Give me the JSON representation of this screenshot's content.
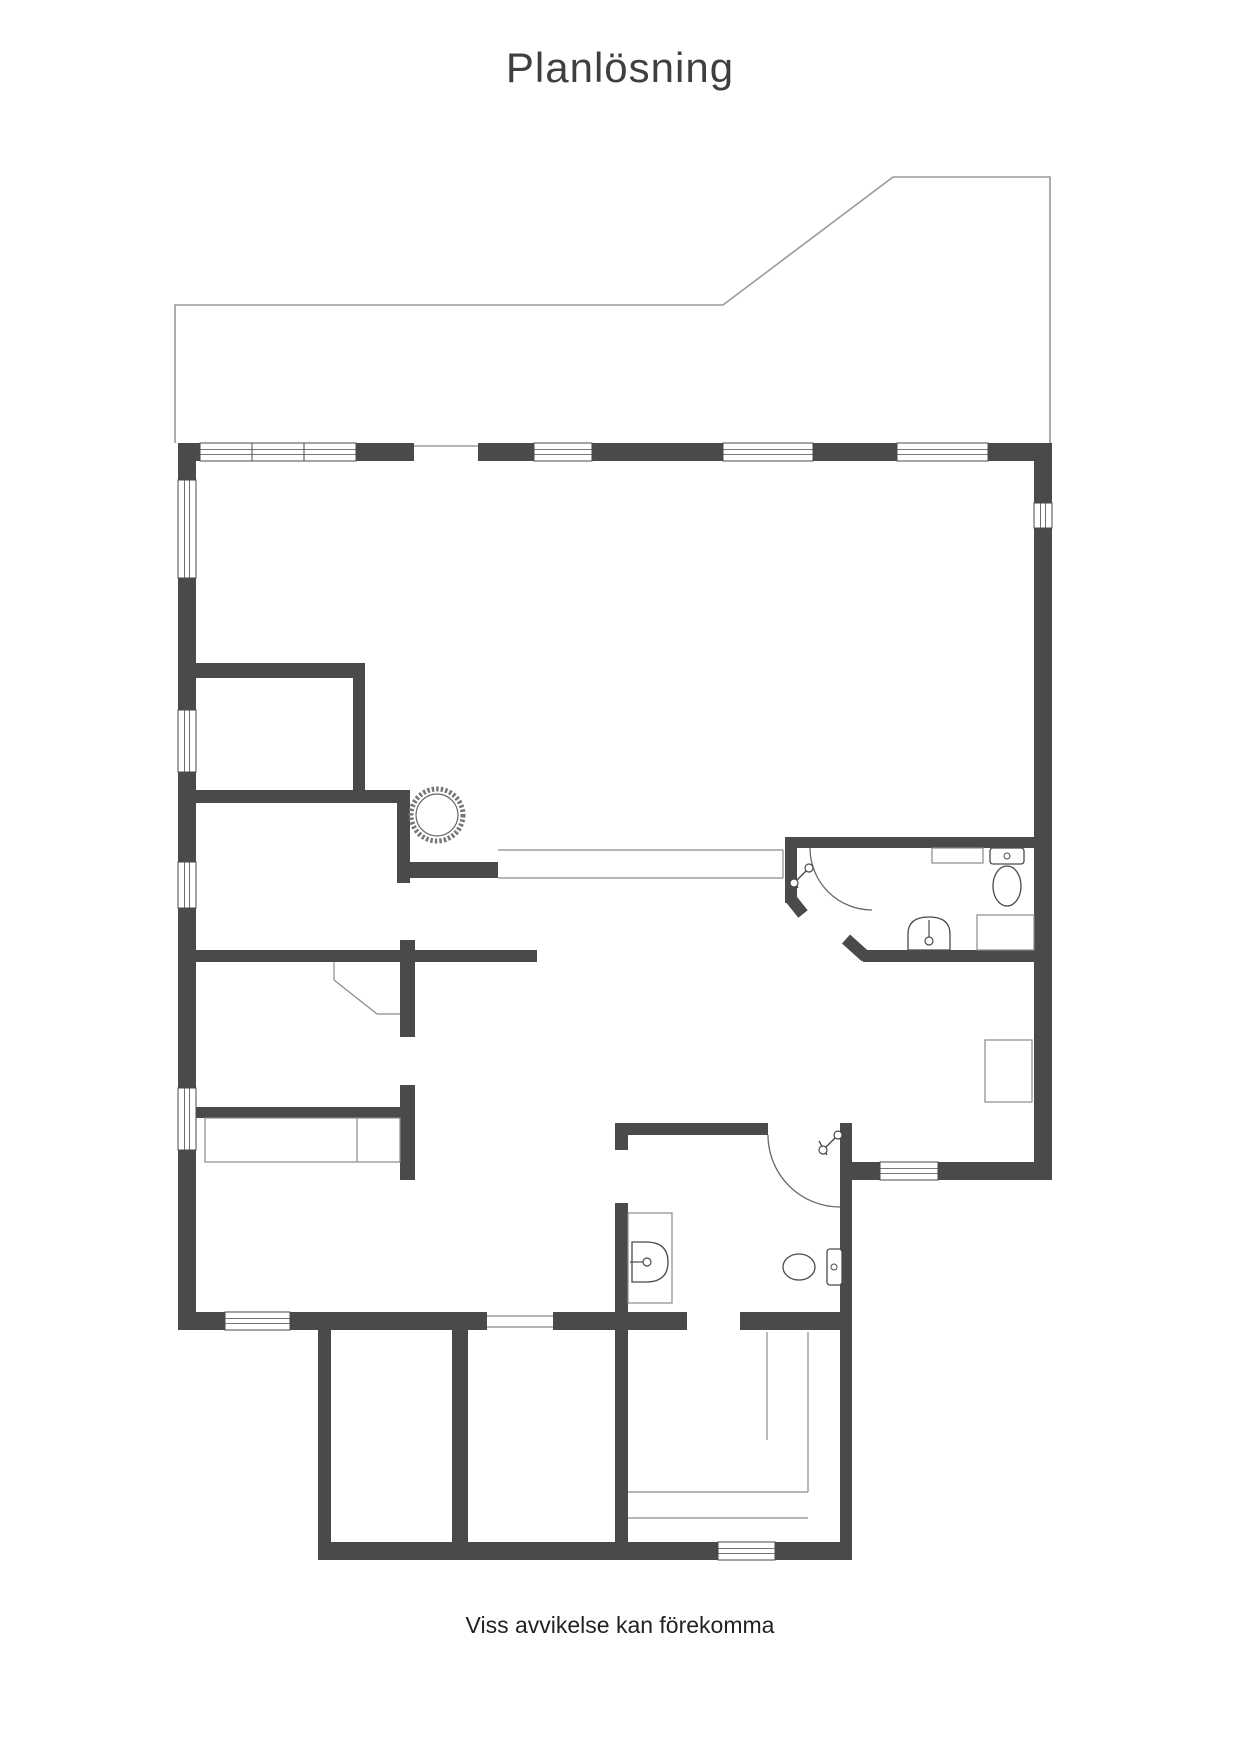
{
  "page": {
    "title": "Planlösning",
    "footer": "Viss avvikelse kan förekomma"
  },
  "colors": {
    "wall": "#4a4a4a",
    "thin": "#8a8a8a",
    "deck": "#999999",
    "fixture": "#4a4a4a",
    "background": "#ffffff"
  },
  "floorplan": {
    "canvas": {
      "width": 1240,
      "height": 1754
    },
    "deck_outline": "M175,443 L175,305 L723,305 L893,177 L1050,177 L1050,443",
    "walls": [
      [
        178,
        443,
        22,
        18
      ],
      [
        356,
        443,
        58,
        18
      ],
      [
        478,
        443,
        56,
        18
      ],
      [
        592,
        443,
        131,
        18
      ],
      [
        813,
        443,
        84,
        18
      ],
      [
        988,
        443,
        64,
        18
      ],
      [
        178,
        461,
        18,
        19
      ],
      [
        178,
        578,
        18,
        132
      ],
      [
        178,
        772,
        18,
        90
      ],
      [
        178,
        908,
        18,
        180
      ],
      [
        178,
        1150,
        18,
        162
      ],
      [
        1034,
        461,
        18,
        42
      ],
      [
        1034,
        528,
        18,
        634
      ],
      [
        852,
        1162,
        200,
        18
      ],
      [
        178,
        1312,
        309,
        18
      ],
      [
        553,
        1312,
        134,
        18
      ],
      [
        740,
        1312,
        112,
        18
      ],
      [
        318,
        1330,
        13,
        212
      ],
      [
        318,
        1542,
        534,
        18
      ],
      [
        452,
        1330,
        16,
        212
      ],
      [
        615,
        1123,
        13,
        27
      ],
      [
        615,
        1203,
        13,
        339
      ],
      [
        617,
        1123,
        151,
        12
      ],
      [
        840,
        1123,
        12,
        419
      ],
      [
        196,
        663,
        169,
        15
      ],
      [
        353,
        678,
        12,
        112
      ],
      [
        196,
        790,
        214,
        13
      ],
      [
        397,
        803,
        13,
        80
      ],
      [
        410,
        862,
        88,
        16
      ],
      [
        196,
        950,
        341,
        12
      ],
      [
        400,
        940,
        15,
        97
      ],
      [
        196,
        1107,
        204,
        11
      ],
      [
        400,
        1085,
        15,
        95
      ],
      [
        785,
        837,
        249,
        11
      ],
      [
        785,
        837,
        12,
        66
      ],
      [
        863,
        950,
        171,
        12
      ]
    ],
    "diag_walls": [
      [
        791,
        899,
        803,
        914,
        12
      ],
      [
        846,
        939,
        866,
        957,
        12
      ]
    ],
    "windows": [
      [
        200,
        443,
        52,
        18,
        "h"
      ],
      [
        252,
        443,
        52,
        18,
        "h"
      ],
      [
        304,
        443,
        52,
        18,
        "h"
      ],
      [
        534,
        443,
        58,
        18,
        "h"
      ],
      [
        723,
        443,
        90,
        18,
        "h"
      ],
      [
        897,
        443,
        91,
        18,
        "h"
      ],
      [
        178,
        480,
        18,
        98,
        "v"
      ],
      [
        178,
        710,
        18,
        62,
        "v"
      ],
      [
        178,
        862,
        18,
        46,
        "v"
      ],
      [
        178,
        1088,
        18,
        62,
        "v"
      ],
      [
        1034,
        503,
        18,
        25,
        "v"
      ],
      [
        880,
        1162,
        58,
        18,
        "h"
      ],
      [
        718,
        1542,
        57,
        18,
        "h"
      ],
      [
        225,
        1312,
        65,
        18,
        "h"
      ]
    ],
    "thin_lines": [
      [
        414,
        446,
        478,
        446
      ],
      [
        487,
        1316,
        553,
        1316
      ],
      [
        487,
        1327,
        553,
        1327
      ],
      [
        498,
        850,
        783,
        850
      ],
      [
        498,
        878,
        783,
        878
      ],
      [
        783,
        850,
        783,
        878
      ],
      [
        334,
        962,
        334,
        980
      ],
      [
        334,
        980,
        377,
        1014
      ],
      [
        377,
        1014,
        400,
        1014
      ],
      [
        357,
        1118,
        357,
        1162
      ],
      [
        767,
        1332,
        767,
        1440
      ],
      [
        808,
        1332,
        808,
        1440
      ],
      [
        808,
        1440,
        808,
        1492
      ],
      [
        628,
        1492,
        808,
        1492
      ],
      [
        628,
        1518,
        808,
        1518
      ]
    ],
    "thin_rects": [
      [
        205,
        1118,
        195,
        44
      ],
      [
        628,
        1213,
        44,
        90
      ],
      [
        932,
        848,
        51,
        15
      ],
      [
        977,
        915,
        57,
        35
      ],
      [
        985,
        1040,
        47,
        62
      ]
    ],
    "door_arcs": [
      "M810,848 A62,62 0 0 0 872,910",
      "M768,1135 A72,72 0 0 0 840,1207"
    ],
    "fixtures": {
      "stove": {
        "cx": 437,
        "cy": 815,
        "r": 26
      },
      "toilets": [
        {
          "tank": [
            990,
            848,
            34,
            16
          ],
          "bowl": [
            1007,
            886,
            14,
            20
          ],
          "button": [
            1007,
            856
          ]
        },
        {
          "tank": [
            827,
            1249,
            15,
            36
          ],
          "bowl": [
            799,
            1267,
            16,
            13
          ],
          "button": [
            834,
            1267
          ]
        }
      ],
      "sinks": [
        {
          "body": "M908,950 L908,934 Q908,917 929,917 Q950,917 950,934 L950,950 Z",
          "tap_line": [
            929,
            920,
            929,
            938
          ],
          "tap_dot": [
            929,
            941
          ]
        },
        {
          "body": "M632,1242 L646,1242 Q668,1242 668,1262 Q668,1282 646,1282 L632,1282 Z",
          "tap_line": [
            630,
            1262,
            644,
            1262
          ],
          "tap_dot": [
            647,
            1262
          ]
        }
      ],
      "shower_valves": [
        [
          801,
          876
        ],
        [
          830,
          1143
        ]
      ]
    }
  }
}
